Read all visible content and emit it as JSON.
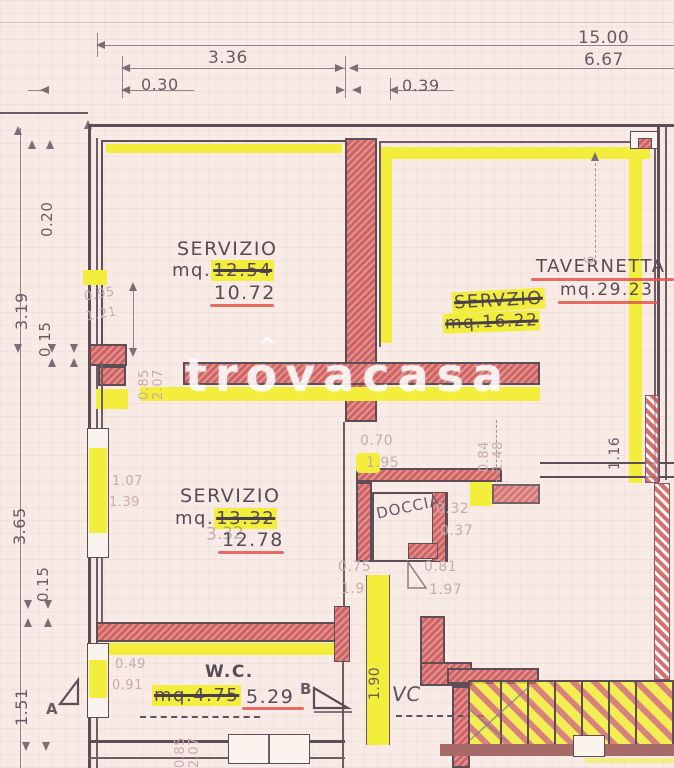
{
  "colors": {
    "paper": "#f8ebe6",
    "ink": "#5c4d57",
    "red_wall": "#d06361",
    "red_annotation": "#e0564d",
    "yellow_highlight": "#f2ee3b",
    "pencil": "#75656f",
    "watermark": "rgba(255,255,255,0.78)"
  },
  "watermark": {
    "text": "trovacasa",
    "roof": "^"
  },
  "dims": {
    "top": {
      "total": "15.00",
      "half": "6.67",
      "room": "3.36",
      "w030": "0.30",
      "w039": "0.39"
    },
    "left": {
      "w020": "0.20",
      "h319": "3.19",
      "w015a": "0.15",
      "h365": "3.65",
      "w015b": "0.15",
      "h151": "1.51"
    },
    "small": {
      "v095": "0.95",
      "v121": "1.21",
      "v085a": "0.85",
      "v207a": "2.07",
      "v107": "1.07",
      "v139": "1.39",
      "v049": "0.49",
      "v091": "0.91",
      "v070": "0.70",
      "v195": "1.95",
      "v084": "0.84",
      "v148": "1.48",
      "v116": "1.16",
      "v032": "0.32",
      "v037": "0.37",
      "v075": "0.75",
      "v19": "1.9",
      "v081": "0.81",
      "v197": "1.97",
      "v190": "1.90",
      "v085b": "0.85",
      "v207b": "2.07",
      "v6": "6"
    }
  },
  "rooms": {
    "servizio_top": {
      "name": "SERVIZIO",
      "prefix": "mq.",
      "old": "12.54",
      "new": "10.72"
    },
    "tavernetta": {
      "name": "TAVERNETTA",
      "area": "mq.29.23"
    },
    "servzio_right": {
      "line1": "SERVZIO",
      "line2": "mq.16.22"
    },
    "servizio_mid": {
      "name": "SERVIZIO",
      "prefix": "mq.",
      "old": "13.32",
      "ghost": "3.32",
      "new": "12.78"
    },
    "wc": {
      "name": "W.C.",
      "old": "mq.4.75",
      "new": "5.29"
    },
    "doccia_label": "DOCCIA",
    "vc_label": "VC"
  },
  "markers": {
    "a": "A",
    "b": "B"
  }
}
